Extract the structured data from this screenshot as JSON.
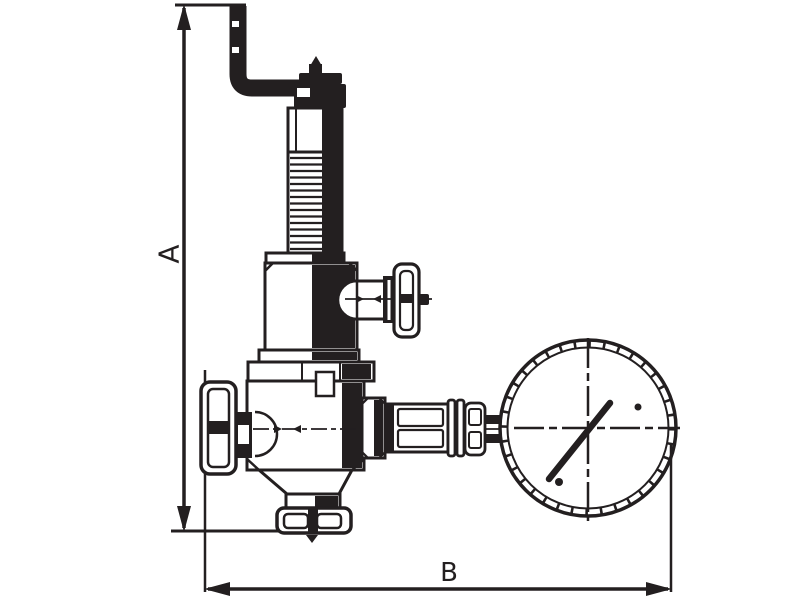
{
  "diagram": {
    "type": "technical-line-drawing",
    "background_color": "#ffffff",
    "ink_color": "#231f20",
    "dimension_labels": {
      "a": "A",
      "b": "B"
    },
    "components": [
      "vent-pipe",
      "adjusting-cap",
      "spring-housing",
      "bonnet",
      "side-port-handwheel",
      "valve-body",
      "inlet-handwheel",
      "outlet-union-nut",
      "gauge-connection-pipe",
      "pressure-gauge",
      "gauge-needle"
    ]
  }
}
